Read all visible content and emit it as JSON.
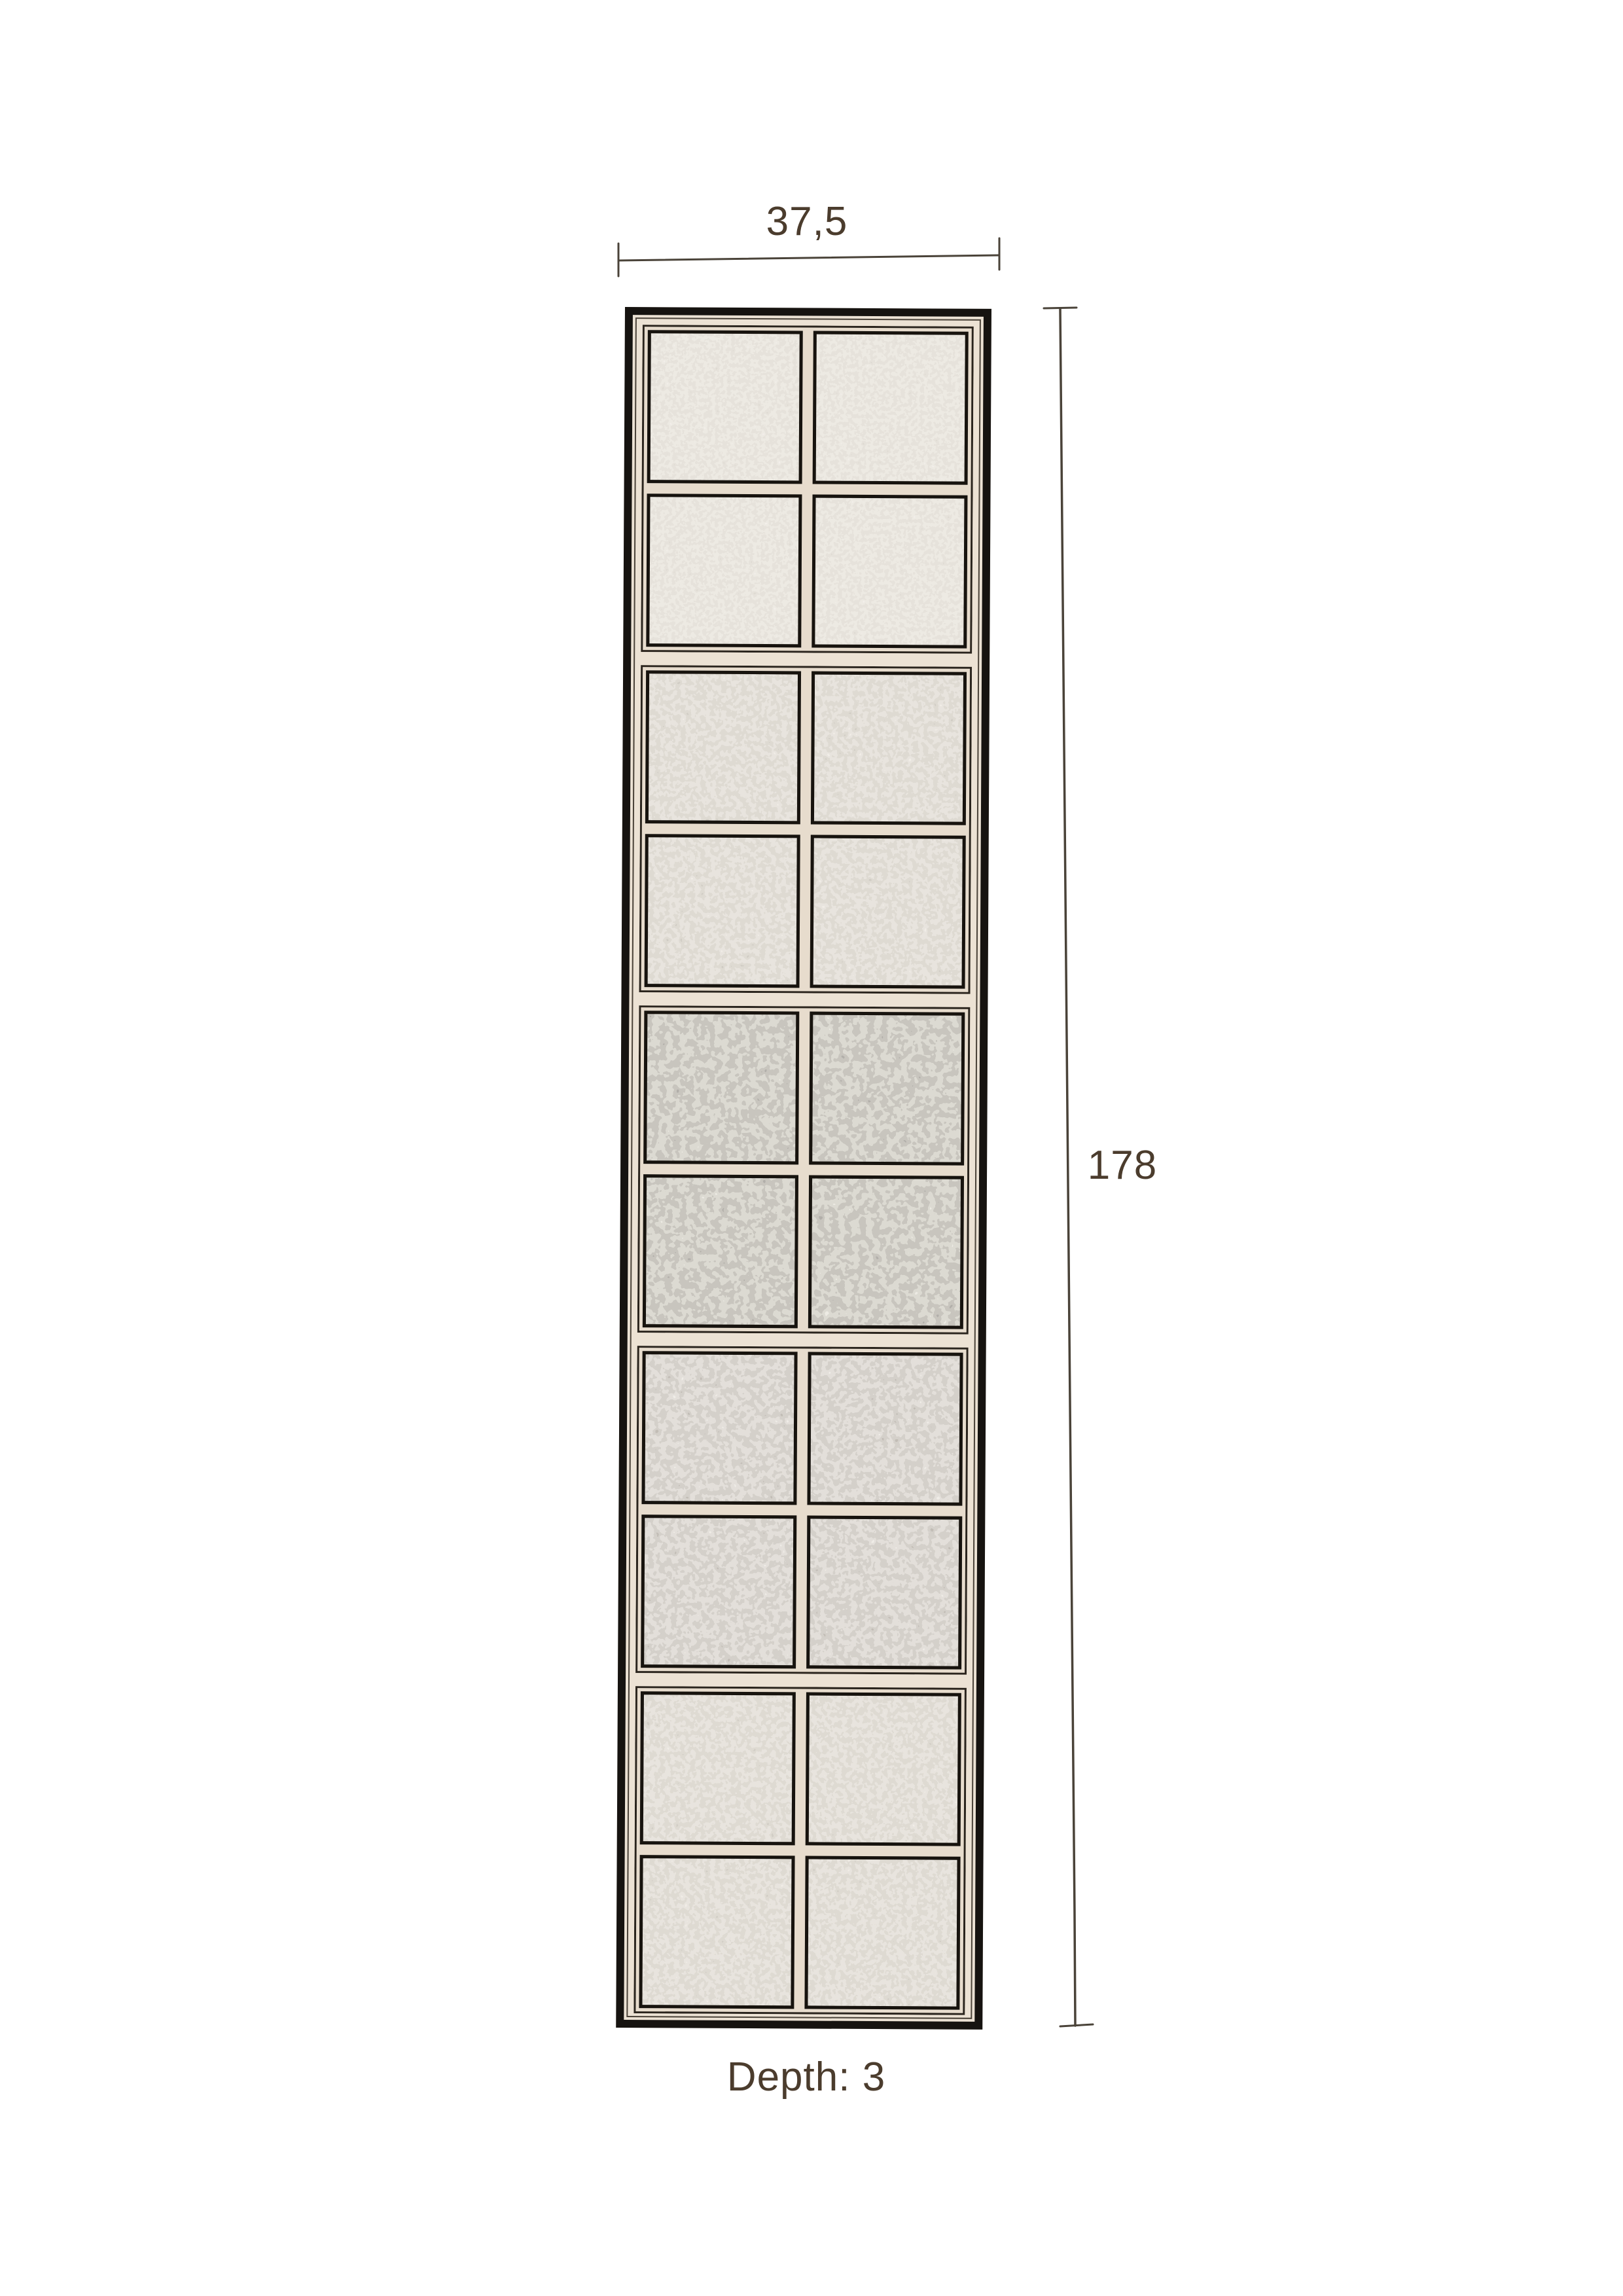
{
  "product_diagram": {
    "width_label": "37,5",
    "height_label": "178",
    "depth_label": "Depth: 3"
  },
  "panel": {
    "description": "tall antique glass-block divider panel, front view",
    "columns": 2,
    "rows": 10,
    "block_groups": 5,
    "group_textures": [
      "fine",
      "medium",
      "coarse",
      "medium-coarse",
      "medium"
    ],
    "group_seeds": [
      11,
      23,
      5,
      47,
      8
    ]
  },
  "colors": {
    "background": "#ffffff",
    "text": "#4b3c2d",
    "dimension_line": "#4a4339",
    "frame_outer": "#161310",
    "frame_light": "#ece2d4",
    "frame_inner_line": "#4a4238",
    "group_frame": "#2a241d",
    "pane_border": "#17130e",
    "pane_base": "#c9c1b5",
    "mullion": "#e7dccd"
  }
}
